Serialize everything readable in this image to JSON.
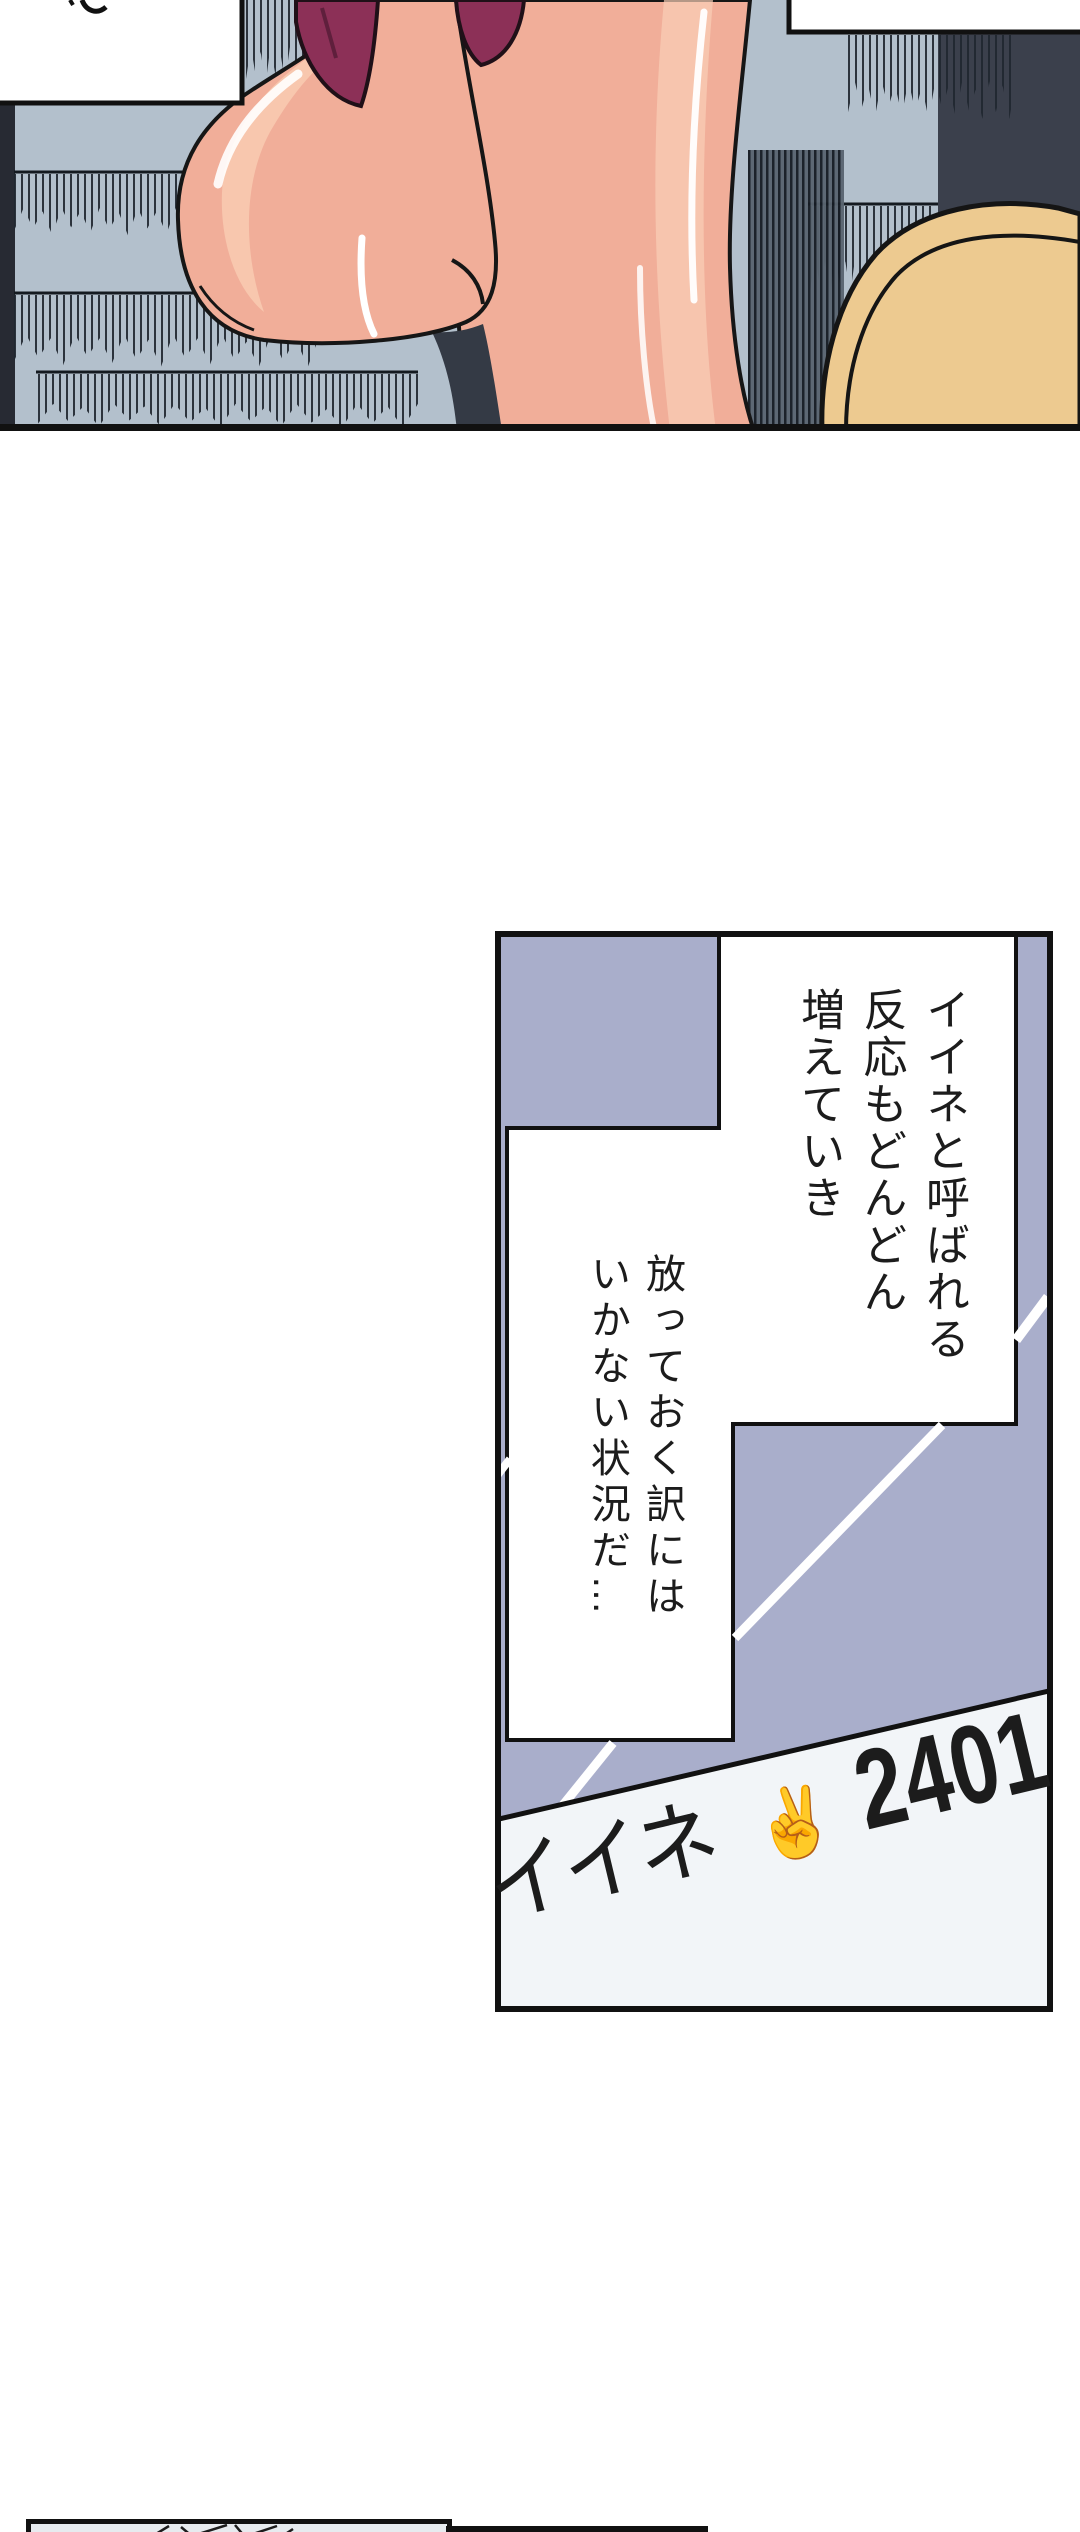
{
  "page": {
    "width": 1080,
    "height": 2532,
    "background": "#ffffff"
  },
  "colors": {
    "stair_background": "#b3c0cc",
    "panel_lavender": "#a9aecb",
    "skin": "#f1ae99",
    "skin_highlight": "#f9cfb6",
    "skirt_maroon": "#8c3057",
    "bag_beige": "#edca90",
    "dark_corner": "#3b404c",
    "dark_strip": "#272a33",
    "line_black": "#141414",
    "bottom_surface": "#f2f5f8",
    "mini_panel_fill": "#e7ebef"
  },
  "speech_increase": {
    "lines": [
      "イイネと呼ばれる",
      "反応もどんどん",
      "増えていき"
    ]
  },
  "speech_situation": {
    "lines": [
      "放っておく訳には",
      "いかない状況だ…"
    ]
  },
  "like_counter": {
    "label": "イイネ",
    "hand": "✌",
    "count": "2401"
  }
}
